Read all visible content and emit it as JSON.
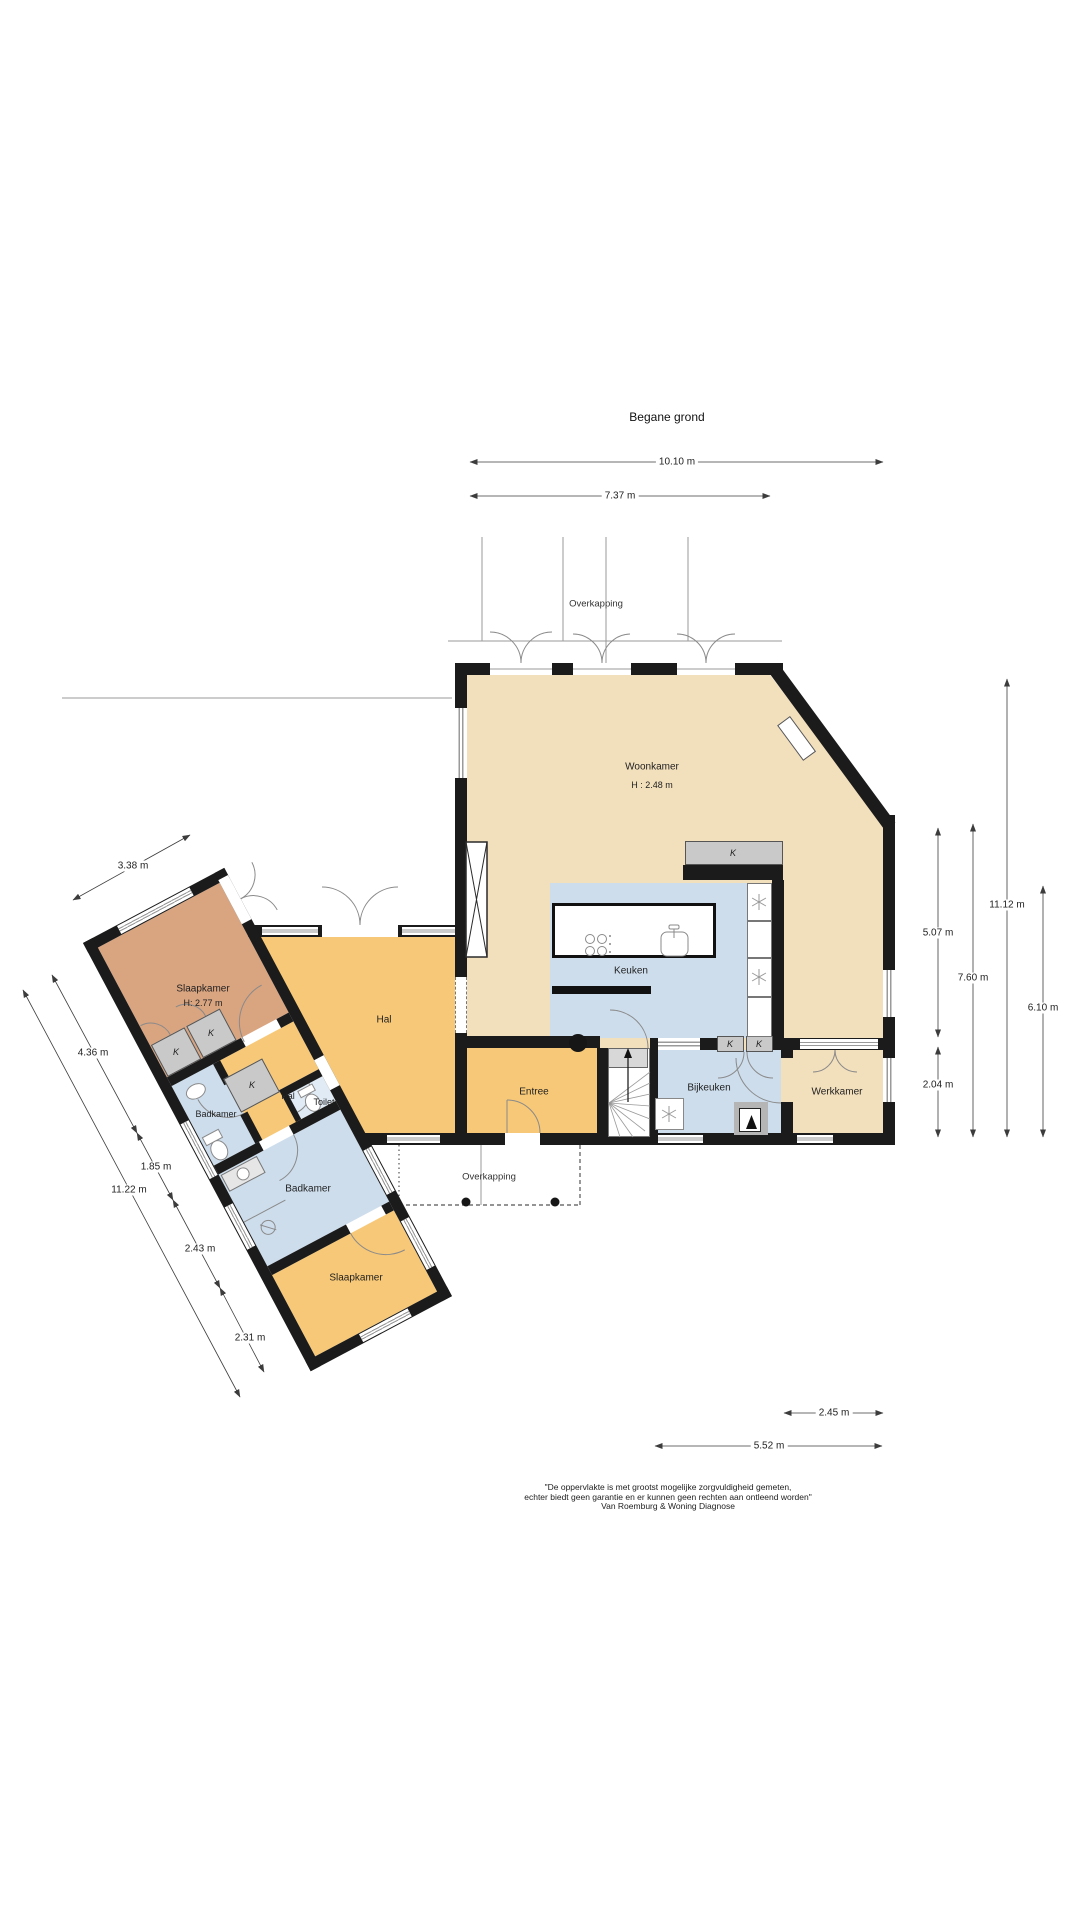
{
  "title": "Begane grond",
  "floor_labels": {
    "woonkamer": {
      "name": "Woonkamer",
      "height": "H : 2.48 m"
    },
    "keuken": {
      "name": "Keuken"
    },
    "entree": {
      "name": "Entree"
    },
    "bijkeuken": {
      "name": "Bijkeuken"
    },
    "werkkamer": {
      "name": "Werkkamer"
    },
    "hal": {
      "name": "Hal"
    },
    "slaapkamer1": {
      "name": "Slaapkamer",
      "height": "H: 2.77 m"
    },
    "badkamer1": {
      "name": "Badkamer"
    },
    "hal2": {
      "name": "Hal"
    },
    "toilet": {
      "name": "Toilet"
    },
    "badkamer2": {
      "name": "Badkamer"
    },
    "slaapkamer2": {
      "name": "Slaapkamer"
    },
    "closet": "K"
  },
  "annotations": {
    "overkapping_top": "Overkapping",
    "overkapping_bottom": "Overkapping"
  },
  "dimensions": {
    "top": [
      {
        "label": "10.10 m"
      },
      {
        "label": "7.37 m"
      }
    ],
    "right": [
      {
        "label": "11.12 m"
      },
      {
        "label": "7.60 m"
      },
      {
        "label": "6.10 m"
      },
      {
        "label": "5.07 m"
      },
      {
        "label": "2.04 m"
      }
    ],
    "bottom": [
      {
        "label": "2.45 m"
      },
      {
        "label": "5.52 m"
      }
    ],
    "left": [
      {
        "label": "3.38 m"
      },
      {
        "label": "4.36 m"
      },
      {
        "label": "1.85 m"
      },
      {
        "label": "11.22 m"
      },
      {
        "label": "2.43 m"
      },
      {
        "label": "2.31 m"
      }
    ]
  },
  "footer": {
    "line1": "\"De oppervlakte is met grootst mogelijke zorgvuldigheid gemeten,",
    "line2": "echter biedt geen garantie en er kunnen geen rechten aan ontleend worden\"",
    "line3": "Van Roemburg & Woning Diagnose"
  },
  "colors": {
    "wall": "#1b1b1b",
    "beige": "#f2dfbc",
    "orange": "#f7c877",
    "blue": "#cdddec",
    "salmon": "#d9a480",
    "toilet_blue": "#e0ebf5",
    "closet_gray": "#c9c9c9",
    "line": "#8a8a8a"
  }
}
